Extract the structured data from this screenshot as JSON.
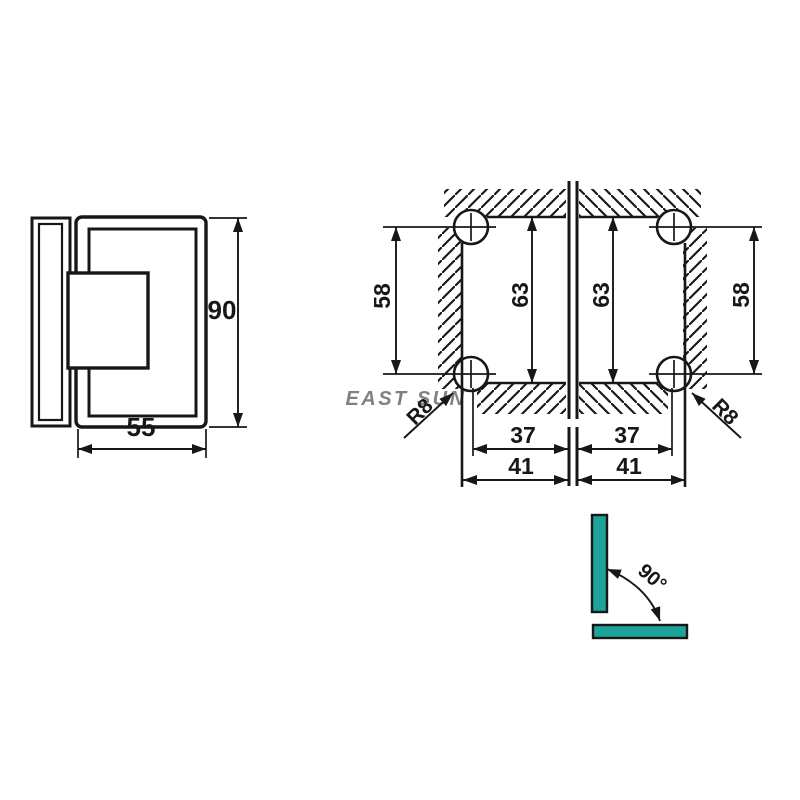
{
  "watermark": {
    "text": "EAST SUN",
    "color": "#ee857e"
  },
  "side_view": {
    "height": "90",
    "width": "55"
  },
  "front_view": {
    "left_glass": {
      "hole_spacing_vertical": "58",
      "cutout_height": "63",
      "hole_spacing_horizontal": "37",
      "cutout_width": "41",
      "corner_radius": "R8"
    },
    "right_glass": {
      "hole_spacing_vertical": "58",
      "cutout_height": "63",
      "hole_spacing_horizontal": "37",
      "cutout_width": "41",
      "corner_radius": "R8"
    }
  },
  "angle_diagram": {
    "angle": "90°",
    "glass_color": "#1ea29c"
  }
}
